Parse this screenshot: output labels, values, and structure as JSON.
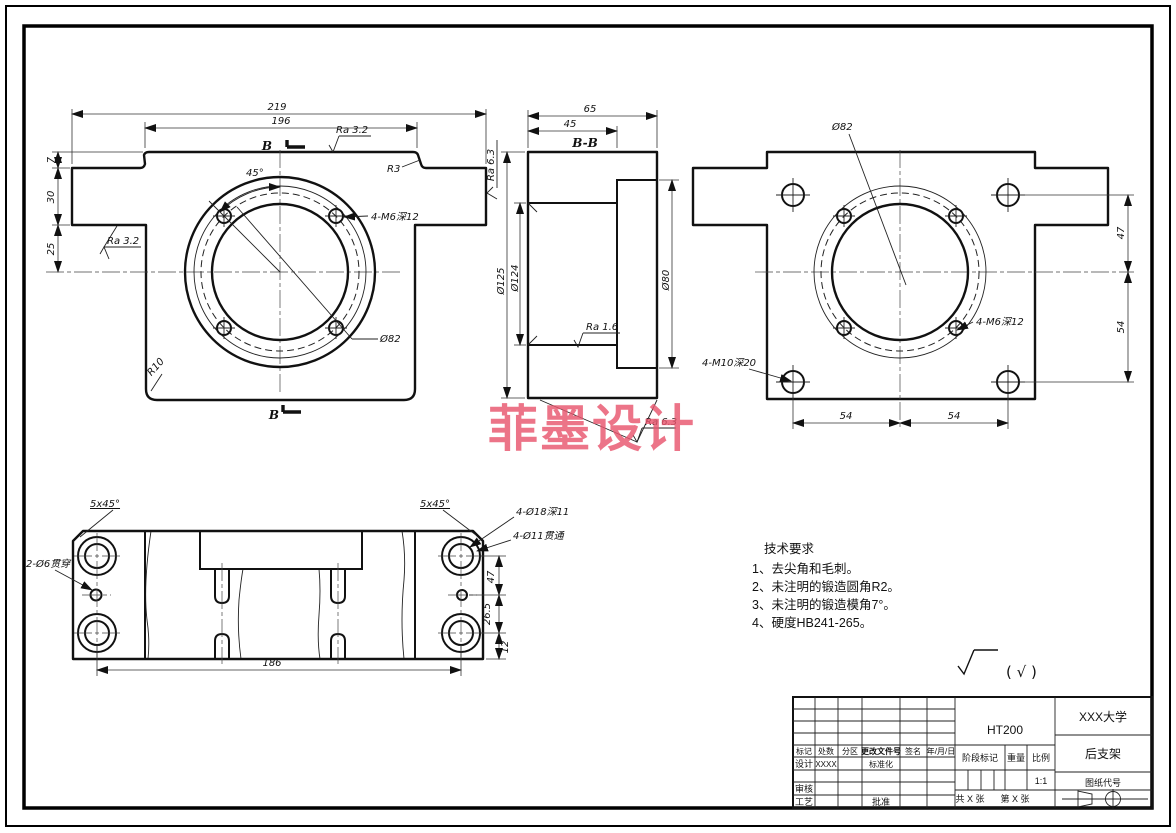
{
  "colors": {
    "line": "#111111",
    "watermark": "#e8566e"
  },
  "watermark": {
    "text": "菲墨设计"
  },
  "front_view": {
    "dim_219": "219",
    "dim_196": "196",
    "dim_7": "7",
    "dim_30": "30",
    "dim_25": "25",
    "ra_top": "Ra 3.2",
    "ra_left": "Ra 3.2",
    "ra_right": "Ra 6.3",
    "r3": "R3",
    "r10": "R10",
    "angle_45": "45°",
    "holes_label": "4-M6深12",
    "bolt_circle": "Ø82",
    "section_letter_top": "B",
    "section_letter_bottom": "B"
  },
  "section_view": {
    "title": "B-B",
    "dim_65": "65",
    "dim_45": "45",
    "dia_125": "Ø125",
    "dia_124": "Ø124",
    "dia_80": "Ø80",
    "ra_bore": "Ra 1.6",
    "ra_bottom": "Ra 6.3"
  },
  "rear_view": {
    "bolt_circle": "Ø82",
    "dim_47": "47",
    "dim_54_right": "54",
    "dim_54_left": "54",
    "dim_54_bottom": "54",
    "m6_label": "4-M6深12",
    "m10_label": "4-M10深20"
  },
  "bottom_view": {
    "chamfer_left": "5x45°",
    "chamfer_right": "5x45°",
    "hole_6": "2-Ø6贯穿",
    "hole_18": "4-Ø18深11",
    "hole_11": "4-Ø11贯通",
    "dim_186": "186",
    "dim_47": "47",
    "dim_265": "26.5",
    "dim_12": "12"
  },
  "tech_req": {
    "title": "技术要求",
    "line1": "1、去尖角和毛刺。",
    "line2": "2、未注明的锻造圆角R2。",
    "line3": "3、未注明的锻造模角7°。",
    "line4": "4、硬度HB241-265。"
  },
  "roughness_note": "( √ )",
  "title_block": {
    "material": "HT200",
    "company": "XXX大学",
    "part_name": "后支架",
    "drawing_code": "图纸代号",
    "scale_value": "1:1",
    "col_mark": "标记",
    "col_count": "处数",
    "col_zone": "分区",
    "col_doc": "更改文件号",
    "col_sign": "签名",
    "col_date": "年/月/日",
    "row_design": "设计",
    "design_value": "XXXX",
    "row_standard": "标准化",
    "row_check": "审核",
    "row_process": "工艺",
    "row_approve": "批准",
    "stage_label": "阶段标记",
    "weight_label": "重量",
    "scale_label": "比例",
    "sheet_total": "共 X 张",
    "sheet_no": "第 X 张"
  }
}
